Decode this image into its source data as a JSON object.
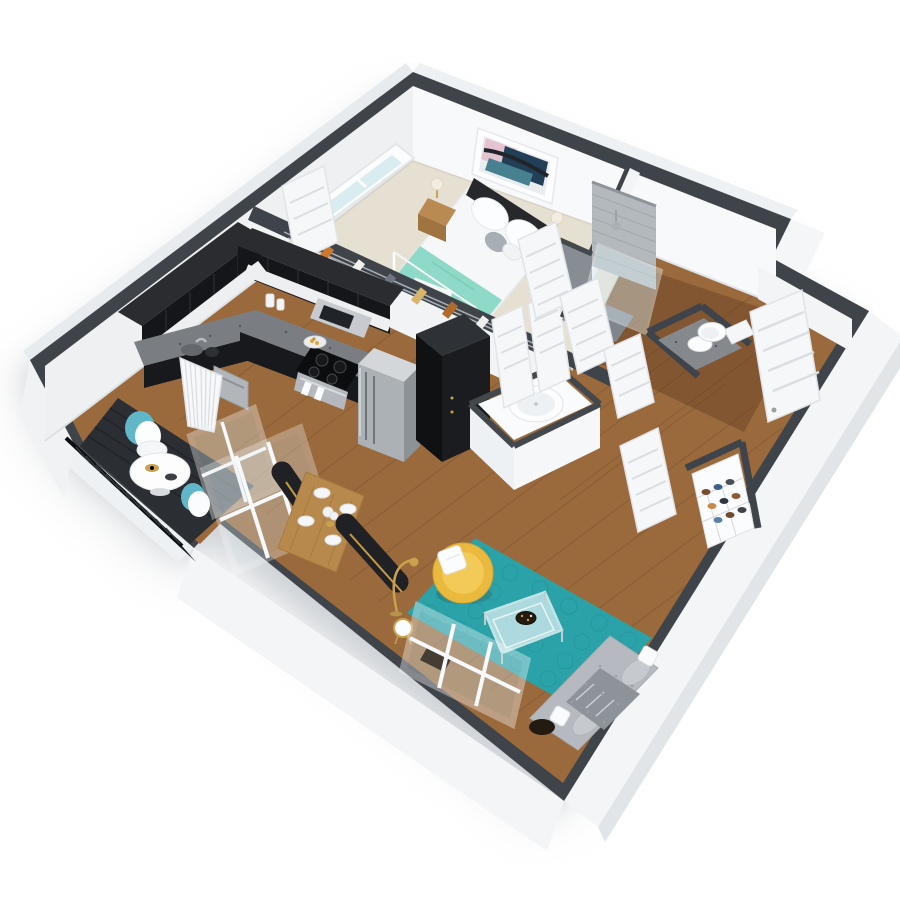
{
  "scene": {
    "type": "3d-floor-plan",
    "description": "Isometric 3D cutaway rendering of a one-bedroom, one-bathroom apartment with balcony",
    "background": "#ffffff"
  },
  "palette": {
    "wall_top": "#3f444a",
    "wall_exterior": "#f3f5f7",
    "wall_light": "#f8f9fa",
    "wall_shaded": "#eef0f2",
    "floor_wood": "#9a6a3c",
    "floor_wood_dark": "#5e3a1e",
    "carpet": "#e6e0d3",
    "deck": "#2b2e32",
    "railing": "#17191c",
    "rug_teal": "#2aa2a8",
    "rug_ring": "#259298",
    "sofa_gray": "#b6bac0",
    "chair_yellow": "#e9ba3d",
    "table_wood": "#b8894d",
    "bench_black": "#1f2125",
    "bench_gold": "#c69a42",
    "cabinet_dark": "#141619",
    "cabinet_top": "#2a2c30",
    "counter_granite": "#7a7e83",
    "steel": "#acb1b6",
    "throw_teal": "#8fd9c8",
    "door_white": "#f6f7f9",
    "tile_gray": "#b4b9be",
    "glass": "#d9ecf0",
    "art_pink": "#e4c4d1",
    "art_navy": "#223f58",
    "art_teal": "#47808f",
    "gold": "#c9a24a"
  },
  "rooms": [
    {
      "name": "bedroom",
      "floor": "beige carpet",
      "furniture": [
        "queen bed with dark headboard",
        "white duvet",
        "teal throw blanket",
        "white canopy posts",
        "two wood nightstands",
        "two table lamps",
        "abstract wall art",
        "leaning mirror",
        "sliding window",
        "foot bench"
      ]
    },
    {
      "name": "bathroom",
      "floor": "wood",
      "furniture": [
        "tiled walk-in shower with glass panel",
        "granite vanity with round sink",
        "toilet"
      ]
    },
    {
      "name": "closet",
      "floor": "carpet",
      "furniture": [
        "hanging rail with clothes",
        "leaning sliding door"
      ]
    },
    {
      "name": "kitchen",
      "floor": "wood",
      "furniture": [
        "L-shaped espresso cabinets",
        "granite countertops",
        "stainless microwave",
        "range with black cooktop and towels",
        "stainless refrigerator",
        "dishwasher",
        "jars",
        "plate of food",
        "kettle",
        "sink"
      ]
    },
    {
      "name": "dining-area",
      "floor": "wood",
      "furniture": [
        "wood dining table",
        "two black benches with brass frames",
        "four place settings",
        "white floral centerpiece"
      ]
    },
    {
      "name": "living-room",
      "floor": "wood",
      "furniture": [
        "teal circle-pattern rug",
        "gray tufted sofa with pillows and throw",
        "glass coffee table with decorative bowl",
        "yellow swivel chair with white pillow",
        "gold arc lamp",
        "round side table",
        "large white-framed window",
        "dark floor bowl"
      ]
    },
    {
      "name": "balcony",
      "floor": "dark deck",
      "furniture": [
        "black slat railing",
        "round white bistro table with plates",
        "two white chairs with teal backs",
        "white louvered panel",
        "sliding glass door frames"
      ]
    },
    {
      "name": "entry-hall",
      "floor": "wood",
      "furniture": [
        "white six-panel entry door",
        "hall closet door",
        "wire shoe rack with shoes",
        "black storage wardrobe",
        "utility enclosure with round water heater",
        "double closet doors"
      ]
    }
  ]
}
